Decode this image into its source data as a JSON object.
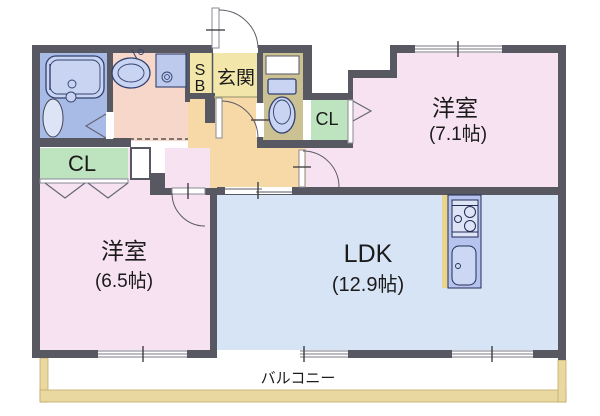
{
  "plan": {
    "kind": "apartment-floor-plan",
    "rooms": {
      "western_room_1": {
        "name": "洋室",
        "size": "(7.1帖)"
      },
      "western_room_2": {
        "name": "洋室",
        "size": "(6.5帖)"
      },
      "ldk": {
        "name": "LDK",
        "size": "(12.9帖)"
      },
      "entrance": {
        "label": "玄関"
      },
      "shoe_box": {
        "top": "S",
        "bottom": "B"
      },
      "closet_right": {
        "label": "CL"
      },
      "closet_left": {
        "label": "CL"
      },
      "balcony": {
        "label": "バルコニー"
      }
    },
    "colors": {
      "wall": "#585862",
      "bedroom_fill": "#f7e2f2",
      "ldk_fill": "#d7e4f5",
      "hallway_fill": "#f6d9a6",
      "entrance_fill": "#f2e6aa",
      "toilet_fill": "#ccc193",
      "closet_fill": "#bee3bf",
      "washroom_fill": "#f7d7ca",
      "bathroom_fill": "#a8bae6",
      "fixture_fill": "#c8d4f2",
      "kitchen_counter_fill": "#b6c3ed",
      "balcony_fill": "#e9d9a1",
      "label_color": "#1b1b1b"
    }
  }
}
